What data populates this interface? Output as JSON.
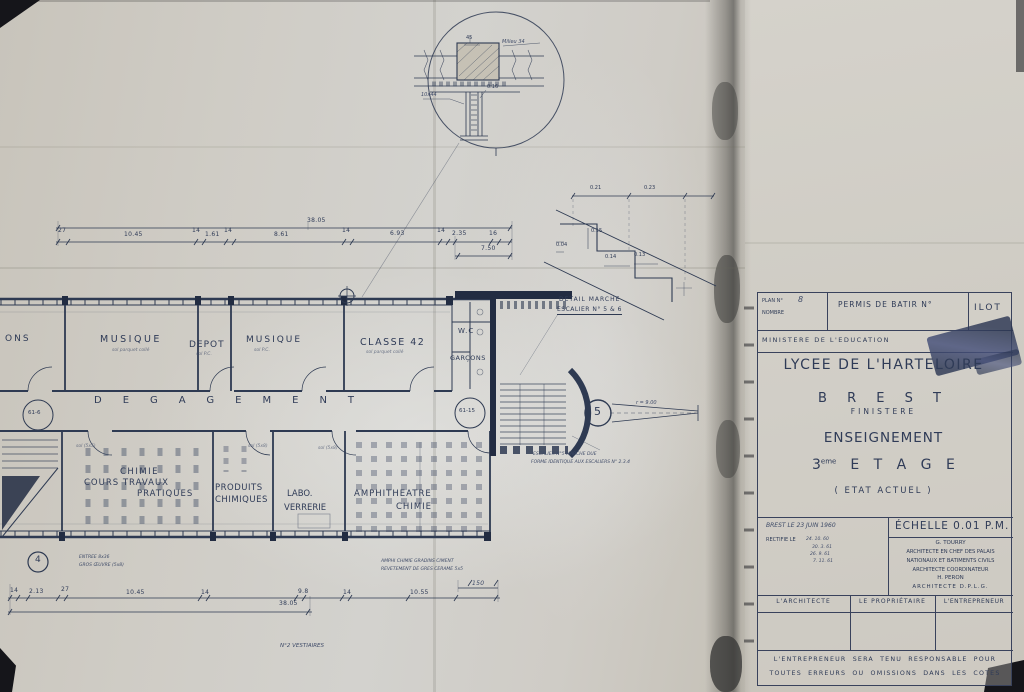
{
  "title_block": {
    "plan_no_label": "PLAN N°",
    "plan_no_value": "8",
    "nombre_label": "NOMBRE",
    "permis_label": "PERMIS DE BATIR N°",
    "ilot_label": "ILOT",
    "ministere": "MINISTERE   DE   L'EDUCATION",
    "title": "LYCEE DE L'HARTELOIRE",
    "city": "B R E S T",
    "department": "FINISTERE",
    "subtitle": "ENSEIGNEMENT",
    "floor_num": "3",
    "floor_sup": "eme",
    "floor_word": "E T A G E",
    "state": "( ETAT ACTUEL )",
    "date_line": "BREST LE 23 JUIN 1960",
    "rectif_label": "RECTIFIE LE",
    "rectif_dates": [
      "24. 10. 60",
      "30. 3. 61",
      "26. 9. 61",
      "7. 11. 61"
    ],
    "echelle": "ÉCHELLE 0.01 P.M.",
    "architects": [
      "G. TOURRY",
      "ARCHITECTE EN CHEF DES PALAIS",
      "NATIONAUX ET BATIMENTS CIVILS",
      "ARCHITECTE  COORDINATEUR",
      "H. PERON",
      "ARCHITECTE  D.P.L.G."
    ],
    "sig_architecte": "L'ARCHITECTE",
    "sig_proprietaire": "LE PROPRIÉTAIRE",
    "sig_entrepreneur": "L'ENTREPRENEUR",
    "disclaimer_1": "L'ENTREPRENEUR SERA TENU RESPONSABLE POUR",
    "disclaimer_2": "TOUTES ERREURS OU OMISSIONS DANS LES COTES"
  },
  "rooms": {
    "ons": "ONS",
    "musique1": "MUSIQUE",
    "musique1_sub": "sol parquet collé",
    "depot": "DEPOT",
    "depot_sub": "sol P.C.",
    "musique2": "MUSIQUE",
    "musique2_sub": "sol P.C.",
    "classe42": "CLASSE 42",
    "classe42_sub": "sol parquet collé",
    "wc": "W.C",
    "garcons": "GARÇONS",
    "degagement": "DEGAGEMENT",
    "chimie": "CHIMIE",
    "cours_travaux": "COURS TRAVAUX",
    "pratiques": "PRATIQUES",
    "produits": "PRODUITS",
    "chimiques": "CHIMIQUES",
    "labo": "LABO.",
    "verrerie": "VERRERIE",
    "amphi": "AMPHITHEATRE",
    "amphi_chimie": "CHIMIE",
    "sol1": "sol (5x5)",
    "sol2": "sol (5x8)",
    "sol3": "sol (5x8)"
  },
  "markers": {
    "circle_left": "61-6",
    "circle_right": "61-15",
    "stair4": "4",
    "stair5": "5",
    "radius": "r = 9.00"
  },
  "notes": {
    "detail_marche_1": "DETAIL MARCHE",
    "detail_marche_2": "ESCALIER N° 5 & 6",
    "esc5_1": "ESCALIER N°5 MARCHE DUE",
    "esc5_2": "FORME IDENTIQUE AUX ESCALIERS N° 2.3.4",
    "amphi_note_1": "AMPHI CHIMIE  GRADINS CIMENT",
    "amphi_note_2": "REVETEMENT DE GRES CERAME 5x5",
    "entree_1": "ENTREE 8x36",
    "entree_2": "GROS ŒUVRE (5x8)",
    "vestiaires": "N°2 VESTIAIRES"
  },
  "dims": {
    "top_total": "38.05",
    "top": [
      "27",
      "10.45",
      "14",
      "1.61",
      "14",
      "8.61",
      "14",
      "6.93",
      "14",
      "2.35",
      "16"
    ],
    "top_drop": "7.50",
    "bottom": [
      "14",
      "2.13",
      "27",
      "10.45",
      "14",
      "9.8",
      "14",
      "10.55"
    ],
    "bottom_total": "38.05",
    "bottom_right": "150"
  },
  "detail_circle": {
    "d45": "45",
    "milieu": "Milieu 34",
    "d016": "0.16",
    "d1044": "10x44"
  },
  "stair_detail": [
    "0.21",
    "0.23",
    "0.15",
    "0.04",
    "0.14",
    "0.13"
  ]
}
